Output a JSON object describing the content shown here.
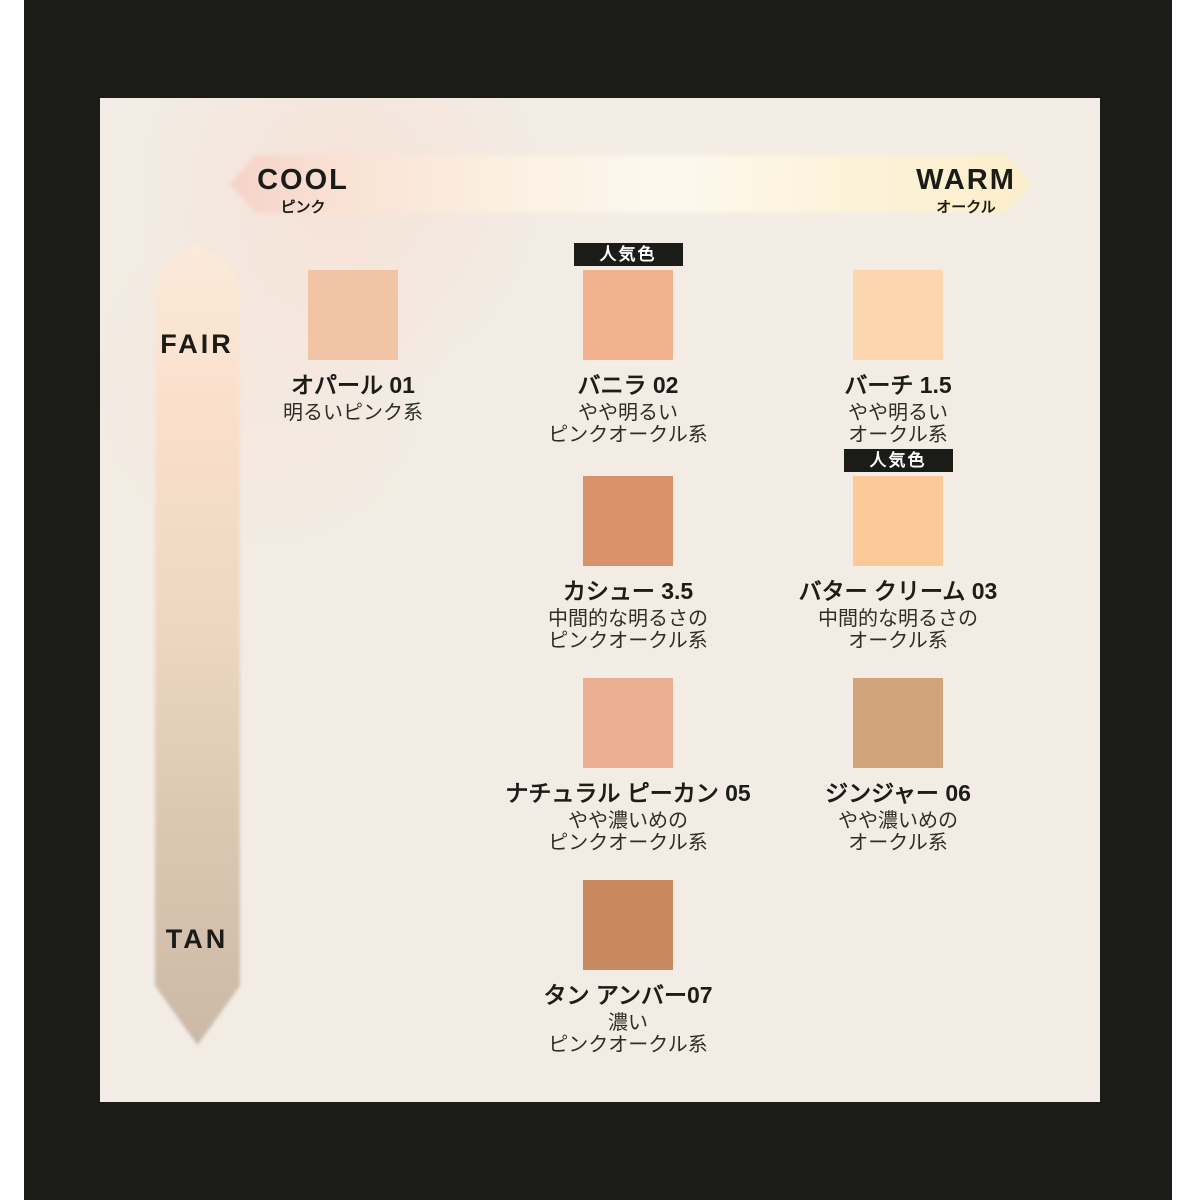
{
  "frame": {
    "outer_background": "#ffffff",
    "border_color": "#1b1b17",
    "panel_background": "#f2ece4"
  },
  "axes": {
    "horizontal": {
      "left_label": "COOL",
      "left_sublabel": "ピンク",
      "right_label": "WARM",
      "right_sublabel": "オークル",
      "gradient_left_color": "#f5d2c8",
      "gradient_right_color": "#fbeec9"
    },
    "vertical": {
      "top_label": "FAIR",
      "bottom_label": "TAN",
      "gradient_top_color": "#fcead9",
      "gradient_bottom_color": "#ccb9a6"
    }
  },
  "popular_badge_label": "人気色",
  "shades": [
    {
      "id": "opal-01",
      "name": "オパール 01",
      "desc_lines": [
        "明るいピンク系"
      ],
      "color": "#f1c4a5",
      "popular": false,
      "row": 1,
      "col": 1
    },
    {
      "id": "vanilla-02",
      "name": "バニラ 02",
      "desc_lines": [
        "やや明るい",
        "ピンクオークル系"
      ],
      "color": "#efb28d",
      "popular": true,
      "row": 1,
      "col": 2
    },
    {
      "id": "birch-1-5",
      "name": "バーチ 1.5",
      "desc_lines": [
        "やや明るい",
        "オークル系"
      ],
      "color": "#fbd6af",
      "popular": false,
      "row": 1,
      "col": 3
    },
    {
      "id": "cashew-3-5",
      "name": "カシュー 3.5",
      "desc_lines": [
        "中間的な明るさの",
        "ピンクオークル系"
      ],
      "color": "#d9916a",
      "popular": false,
      "row": 2,
      "col": 2
    },
    {
      "id": "butter-cream-03",
      "name": "バター クリーム 03",
      "desc_lines": [
        "中間的な明るさの",
        "オークル系"
      ],
      "color": "#fbc897",
      "popular": true,
      "row": 2,
      "col": 3
    },
    {
      "id": "natural-pecan-05",
      "name": "ナチュラル ピーカン 05",
      "desc_lines": [
        "やや濃いめの",
        "ピンクオークル系"
      ],
      "color": "#e9af90",
      "popular": false,
      "row": 3,
      "col": 2
    },
    {
      "id": "ginger-06",
      "name": "ジンジャー 06",
      "desc_lines": [
        "やや濃いめの",
        "オークル系"
      ],
      "color": "#d2a47c",
      "popular": false,
      "row": 3,
      "col": 3
    },
    {
      "id": "tan-amber-07",
      "name": "タン アンバー07",
      "desc_lines": [
        "濃い",
        "ピンクオークル系"
      ],
      "color": "#c9895e",
      "popular": false,
      "row": 4,
      "col": 2
    }
  ]
}
